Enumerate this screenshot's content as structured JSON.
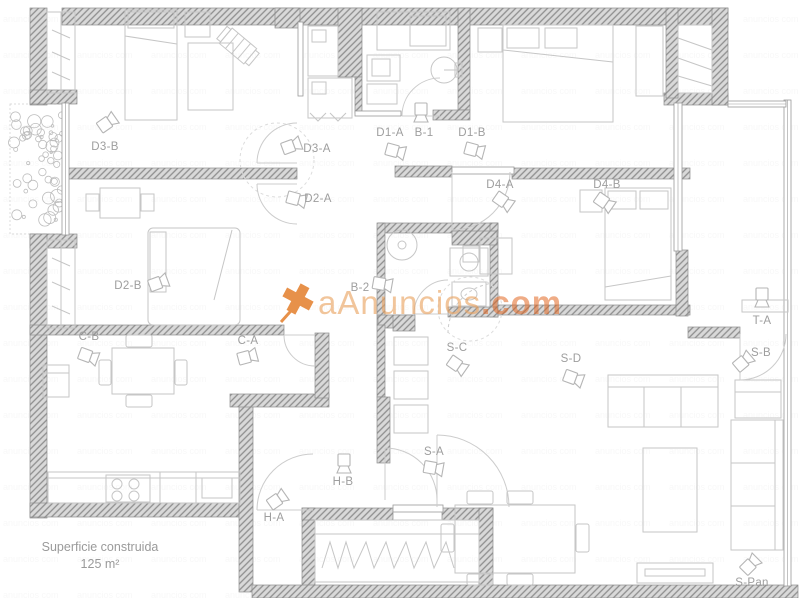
{
  "plan": {
    "watermark": {
      "main": "aAnuncios",
      "suffix": ".com"
    },
    "footer": {
      "line1": "Superficie construida",
      "line2": "125 m²"
    },
    "colors": {
      "wall_fill": "#d9d9d9",
      "wall_line": "#8e8e8e",
      "furniture": "#c6c6c6",
      "label": "#9e9e9e",
      "watermark_main": "#eaa25f",
      "watermark_suffix": "#e2631c",
      "watermark_icon": "#e2761e"
    },
    "rooms": [
      {
        "id": "d3-b",
        "label": "D3-B",
        "x": 105,
        "y": 150,
        "cam": {
          "x": 107,
          "y": 123,
          "rot": -35
        }
      },
      {
        "id": "d3-a",
        "label": "D3-A",
        "x": 317,
        "y": 152,
        "cam": {
          "x": 291,
          "y": 146,
          "rot": -20
        }
      },
      {
        "id": "d2-a",
        "label": "D2-A",
        "x": 318,
        "y": 202,
        "cam": {
          "x": 296,
          "y": 199,
          "rot": 15
        }
      },
      {
        "id": "d1-a",
        "label": "D1-A",
        "x": 390,
        "y": 136,
        "cam": {
          "x": 395,
          "y": 151,
          "rot": 15
        }
      },
      {
        "id": "b-1",
        "label": "B-1",
        "x": 424,
        "y": 136,
        "cam": {
          "x": 421,
          "y": 112,
          "rot": 90
        }
      },
      {
        "id": "d1-b",
        "label": "D1-B",
        "x": 472,
        "y": 136,
        "cam": {
          "x": 474,
          "y": 150,
          "rot": 15
        }
      },
      {
        "id": "d4-a",
        "label": "D4-A",
        "x": 500,
        "y": 188,
        "cam": {
          "x": 503,
          "y": 201,
          "rot": 35
        }
      },
      {
        "id": "d4-b",
        "label": "D4-B",
        "x": 607,
        "y": 188,
        "cam": {
          "x": 604,
          "y": 202,
          "rot": 35
        }
      },
      {
        "id": "d2-b",
        "label": "D2-B",
        "x": 128,
        "y": 289,
        "cam": {
          "x": 158,
          "y": 283,
          "rot": -20
        }
      },
      {
        "id": "b-2",
        "label": "B-2",
        "x": 360,
        "y": 291,
        "cam": {
          "x": 382,
          "y": 284,
          "rot": 10
        }
      },
      {
        "id": "c-b",
        "label": "C-B",
        "x": 89,
        "y": 340,
        "cam": {
          "x": 88,
          "y": 356,
          "rot": 20
        }
      },
      {
        "id": "c-a",
        "label": "C-A",
        "x": 248,
        "y": 344,
        "cam": {
          "x": 247,
          "y": 357,
          "rot": -15
        }
      },
      {
        "id": "s-c",
        "label": "S-C",
        "x": 457,
        "y": 351,
        "cam": {
          "x": 457,
          "y": 365,
          "rot": 35
        }
      },
      {
        "id": "s-d",
        "label": "S-D",
        "x": 571,
        "y": 362,
        "cam": {
          "x": 573,
          "y": 378,
          "rot": 20
        }
      },
      {
        "id": "t-a",
        "label": "T-A",
        "x": 762,
        "y": 324,
        "cam": {
          "x": 762,
          "y": 297,
          "rot": 90
        }
      },
      {
        "id": "s-b",
        "label": "S-B",
        "x": 761,
        "y": 356,
        "cam": {
          "x": 743,
          "y": 362,
          "rot": -40
        }
      },
      {
        "id": "h-b",
        "label": "H-B",
        "x": 343,
        "y": 485,
        "cam": {
          "x": 344,
          "y": 463,
          "rot": 90
        }
      },
      {
        "id": "s-a",
        "label": "S-A",
        "x": 434,
        "y": 455,
        "cam": {
          "x": 433,
          "y": 468,
          "rot": 10
        }
      },
      {
        "id": "h-a",
        "label": "H-A",
        "x": 274,
        "y": 521,
        "cam": {
          "x": 277,
          "y": 500,
          "rot": -35
        }
      },
      {
        "id": "s-pan",
        "label": "S-Pan",
        "x": 752,
        "y": 586,
        "cam": {
          "x": 750,
          "y": 565,
          "rot": -45
        }
      }
    ]
  }
}
